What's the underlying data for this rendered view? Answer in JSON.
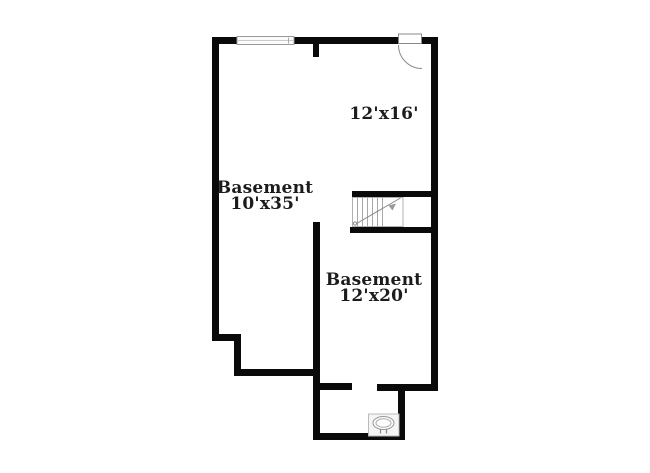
{
  "page": {
    "background_color": "#ffffff",
    "type_note": "residential basement floor plan"
  },
  "floorplan": {
    "wall_color": "#0a0a0a",
    "symbol_color": "#9a9a9a",
    "text_color": "#1c1c1c",
    "rooms": [
      {
        "name": "",
        "dimensions": "12'x16'"
      },
      {
        "name": "Basement",
        "dimensions": "10'x35'"
      },
      {
        "name": "Basement",
        "dimensions": "12'x20'"
      }
    ],
    "symbols": [
      {
        "icon": "window-icon"
      },
      {
        "icon": "door-icon"
      },
      {
        "icon": "stairs-icon"
      },
      {
        "icon": "utility-icon"
      }
    ]
  }
}
